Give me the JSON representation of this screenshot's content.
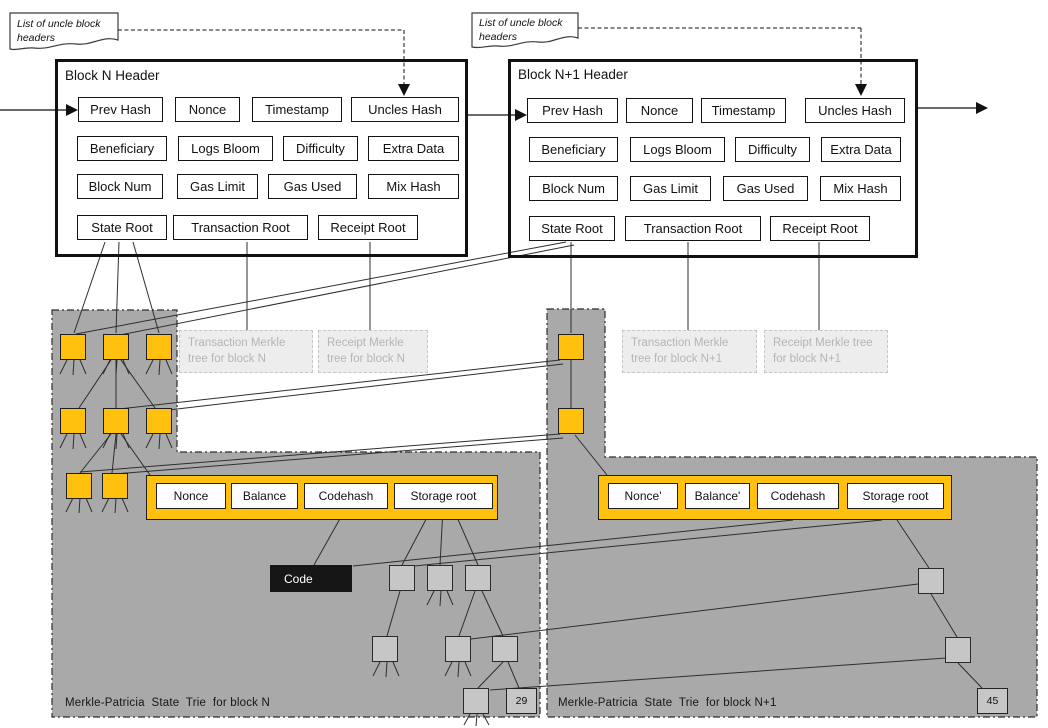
{
  "notes": {
    "left": "List of uncle block headers",
    "right": "List of uncle block headers"
  },
  "blocks": {
    "n": {
      "title": "Block N Header",
      "rows": [
        [
          "Prev Hash",
          "Nonce",
          "Timestamp",
          "Uncles Hash"
        ],
        [
          "Beneficiary",
          "Logs Bloom",
          "Difficulty",
          "Extra Data"
        ],
        [
          "Block Num",
          "Gas Limit",
          "Gas Used",
          "Mix Hash"
        ],
        [
          "State Root",
          "Transaction Root",
          "Receipt Root"
        ]
      ]
    },
    "n1": {
      "title": "Block N+1 Header",
      "rows": [
        [
          "Prev Hash",
          "Nonce",
          "Timestamp",
          "Uncles Hash"
        ],
        [
          "Beneficiary",
          "Logs Bloom",
          "Difficulty",
          "Extra Data"
        ],
        [
          "Block Num",
          "Gas Limit",
          "Gas Used",
          "Mix Hash"
        ],
        [
          "State Root",
          "Transaction Root",
          "Receipt Root"
        ]
      ]
    }
  },
  "merkle_boxes": {
    "tx_n": "Transaction Merkle tree for block N",
    "receipt_n": "Receipt Merkle tree for block N",
    "tx_n1": "Transaction Merkle tree for block N+1",
    "receipt_n1": "Receipt Merkle tree for block N+1"
  },
  "accounts": {
    "n": [
      "Nonce",
      "Balance",
      "Codehash",
      "Storage root"
    ],
    "n1": [
      "Nonce'",
      "Balance'",
      "Codehash",
      "Storage root"
    ]
  },
  "code_label": "Code",
  "storage_leaves": {
    "n": "29",
    "n1": "45"
  },
  "trie_labels": {
    "n": "Merkle-Patricia  State  Trie  for block N",
    "n1": "Merkle-Patricia  State  Trie  for block N+1"
  },
  "colors": {
    "node_orange": "#FFC10D",
    "region_gray": "#A9A9A9",
    "storage_gray": "#C6C6C6",
    "code_bg": "#161616",
    "muted_text": "#B5B5B5",
    "line": "#2E2E2E"
  }
}
